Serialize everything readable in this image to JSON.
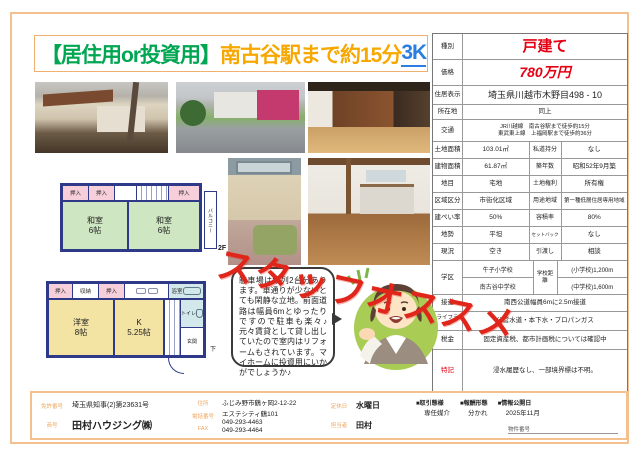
{
  "title": {
    "segment1": "【居住用or投資用】",
    "segment2": "南古谷駅まで約15分",
    "segment3": "3K"
  },
  "stamp": "スタッフオススメ",
  "bubble_text": "駐車場は縦列2台分あります。車通りが少ないとても閑静な立地。前面道路は幅員6mとゆったりですので駐車も楽々♪元々賃貸として貸し出していたので室内はリフォームもされています。マイホームに投資用にいかがでしょうか♪",
  "floorplan": {
    "f2": {
      "closet1": "押入",
      "closet2": "押入",
      "closet3": "押入",
      "room1_name": "和室",
      "room1_size": "6帖",
      "room2_name": "和室",
      "room2_size": "6帖",
      "balcony": "バルコニー",
      "floor_label": "2F"
    },
    "f1": {
      "closet1": "押入",
      "storage": "収納",
      "closet2": "押入",
      "room1_name": "洋室",
      "room1_size": "8帖",
      "kitchen_name": "K",
      "kitchen_size": "5.25帖",
      "bath": "浴室",
      "wash": "洗",
      "toilet": "トイレ",
      "entrance": "玄関",
      "down": "下"
    }
  },
  "spec": {
    "rows": {
      "type": {
        "label": "種別",
        "value": "戸建て"
      },
      "price": {
        "label": "価格",
        "value": "780万円"
      },
      "address": {
        "label": "住居表示",
        "value": "埼玉県川越市木野目498 - 10"
      },
      "location": {
        "label": "所在地",
        "value": "同上"
      },
      "access": {
        "label": "交通",
        "line1": "JR川越線　南古谷駅まで徒歩約15分",
        "line2": "東武東上線　上福岡駅まで徒歩約36分"
      },
      "land": {
        "label": "土地面積",
        "value": "103.01㎡",
        "label2": "私道持分",
        "value2": "なし"
      },
      "building": {
        "label": "建物面積",
        "value": "61.87㎡",
        "label2": "築年数",
        "value2": "昭和52年9月築"
      },
      "landcat": {
        "label": "地目",
        "value": "宅地",
        "label2": "土地権利",
        "value2": "所有権"
      },
      "zoning": {
        "label": "区域区分",
        "value": "市街化区域",
        "label2": "用途地域",
        "value2": "第一種低層住居専用地域"
      },
      "coverage": {
        "label": "建ぺい率",
        "value": "50%",
        "label2": "容積率",
        "value2": "80%"
      },
      "terrain": {
        "label": "地勢",
        "value": "平坦",
        "label2": "セットバック",
        "value2": "なし"
      },
      "status": {
        "label": "現況",
        "value": "空き",
        "label2": "引渡し",
        "value2": "相談"
      },
      "school": {
        "label": "学区",
        "school1": "牛子小学校",
        "school2": "南古谷中学校",
        "label2": "学校距離",
        "dist1": "(小学校)1,200m",
        "dist2": "(中学校)1,600m"
      },
      "road": {
        "label": "接道",
        "value": "南西公道幅員6mに2.5m接道"
      },
      "lifeline": {
        "label": "ライフライン",
        "value": "公営水道・本下水・プロパンガス"
      },
      "tax": {
        "label": "税金",
        "value": "固定資産税、都市計画税については確認中"
      },
      "notes": {
        "label": "特記",
        "value": "浸水履歴なし、一部境界標は不明。"
      }
    }
  },
  "footer": {
    "license_label": "免許番号",
    "license": "埼玉県知事(2)第23631号",
    "company_label": "商号",
    "company": "田村ハウジング㈱",
    "address_label": "住所",
    "address_line1": "ふじみ野市鶴ヶ岡2-12-22",
    "address_line2": "エステシティ鶴101",
    "tel_label": "電話番号",
    "tel": "049-293-4463",
    "fax_label": "FAX",
    "fax": "049-293-4464",
    "holiday_label": "定休日",
    "holiday": "水曜日",
    "staff_label": "担当者",
    "staff": "田村",
    "deal_type_label": "■取引態様",
    "deal_type": "専任媒介",
    "fee_label": "■報酬形態",
    "fee": "分かれ",
    "publish_label": "■情報公開日",
    "publish": "2025年11月",
    "property_no_label": "物件番号"
  }
}
